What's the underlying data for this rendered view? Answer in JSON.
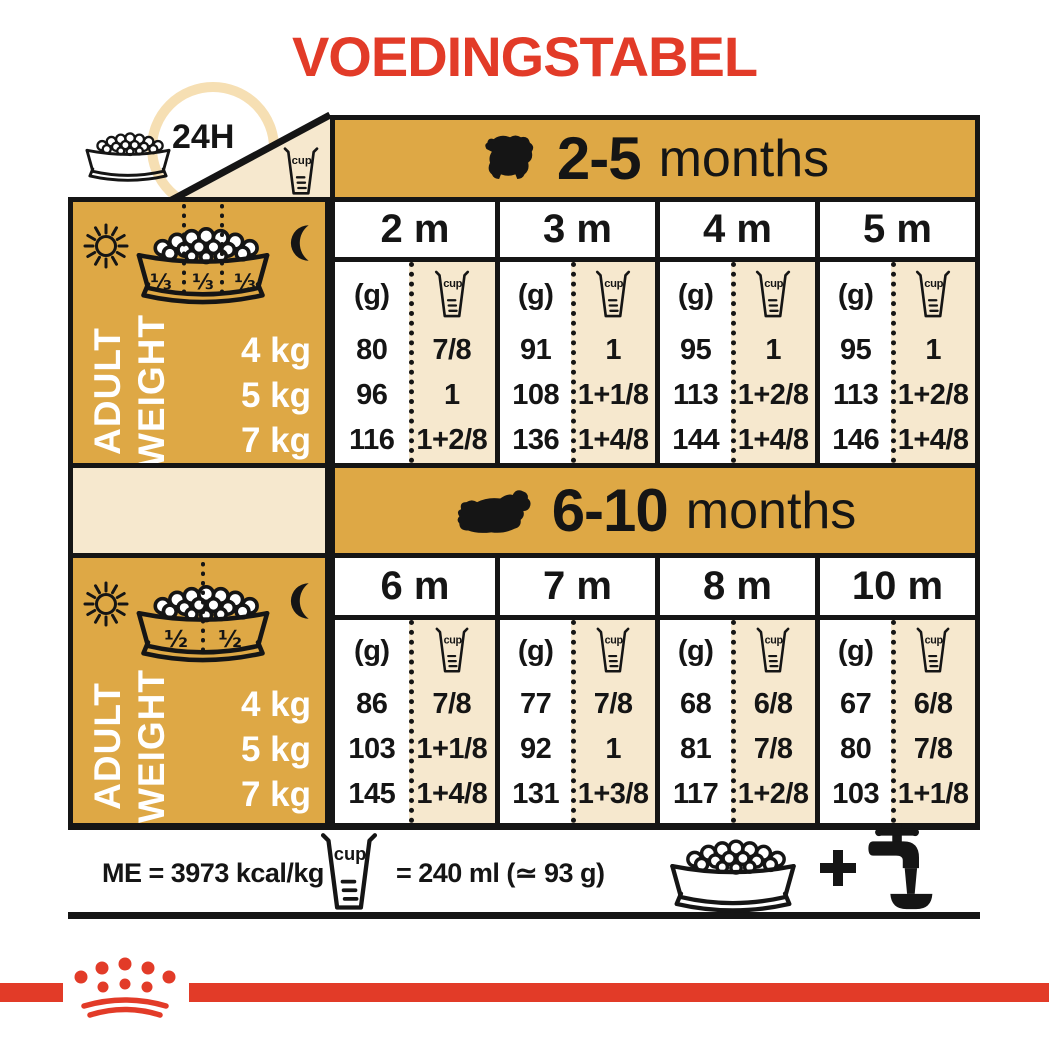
{
  "title": "VOEDINGSTABEL",
  "colors": {
    "red": "#E23B28",
    "gold": "#DEA845",
    "cream": "#F6E8CE",
    "ring": "#F6DFB3",
    "ink": "#151515"
  },
  "top_left": {
    "duration": "24H",
    "cup": "cup"
  },
  "tables": [
    {
      "range": "2-5",
      "suffix": "months",
      "portions": [
        "⅓",
        "⅓",
        "⅓"
      ],
      "adult": "ADULT",
      "weight": "WEIGHT",
      "weights": [
        "4 kg",
        "5 kg",
        "7 kg"
      ],
      "unit": "(g)",
      "cup": "cup",
      "months": [
        {
          "label": "2 m",
          "grams": [
            "80",
            "96",
            "116"
          ],
          "cups": [
            "7/8",
            "1",
            "1+2/8"
          ]
        },
        {
          "label": "3 m",
          "grams": [
            "91",
            "108",
            "136"
          ],
          "cups": [
            "1",
            "1+1/8",
            "1+4/8"
          ]
        },
        {
          "label": "4 m",
          "grams": [
            "95",
            "113",
            "144"
          ],
          "cups": [
            "1",
            "1+2/8",
            "1+4/8"
          ]
        },
        {
          "label": "5 m",
          "grams": [
            "95",
            "113",
            "146"
          ],
          "cups": [
            "1",
            "1+2/8",
            "1+4/8"
          ]
        }
      ]
    },
    {
      "range": "6-10",
      "suffix": "months",
      "portions": [
        "½",
        "½"
      ],
      "adult": "ADULT",
      "weight": "WEIGHT",
      "weights": [
        "4 kg",
        "5 kg",
        "7 kg"
      ],
      "unit": "(g)",
      "cup": "cup",
      "months": [
        {
          "label": "6 m",
          "grams": [
            "86",
            "103",
            "145"
          ],
          "cups": [
            "7/8",
            "1+1/8",
            "1+4/8"
          ]
        },
        {
          "label": "7 m",
          "grams": [
            "77",
            "92",
            "131"
          ],
          "cups": [
            "7/8",
            "1",
            "1+3/8"
          ]
        },
        {
          "label": "8 m",
          "grams": [
            "68",
            "81",
            "117"
          ],
          "cups": [
            "6/8",
            "7/8",
            "1+2/8"
          ]
        },
        {
          "label": "10 m",
          "grams": [
            "67",
            "80",
            "103"
          ],
          "cups": [
            "6/8",
            "7/8",
            "1+1/8"
          ]
        }
      ]
    }
  ],
  "footer": {
    "energy": "ME = 3973 kcal/kg",
    "cup": "cup",
    "equivalence": "= 240 ml (≃ 93 g)"
  }
}
